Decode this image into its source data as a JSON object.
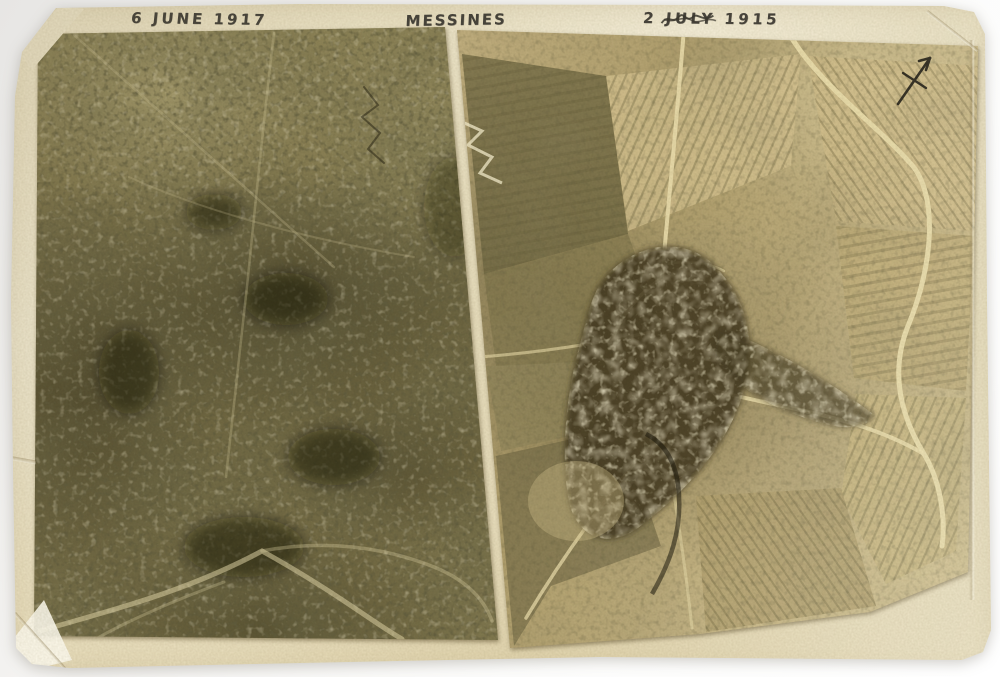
{
  "scene": {
    "background_color": "#f1f0ee"
  },
  "print": {
    "paper_color": "#e9dfc0",
    "ink_color": "#3b3831",
    "labels": {
      "left_date": "6 JUNE 1917",
      "place": "MESSINES",
      "right_date": "2 JULY 1915"
    },
    "photos": {
      "left": {
        "dominant_tone": "#766d45"
      },
      "right": {
        "dominant_tone": "#c7b584"
      }
    },
    "icons": {
      "north_arrow": "north-arrow"
    }
  }
}
